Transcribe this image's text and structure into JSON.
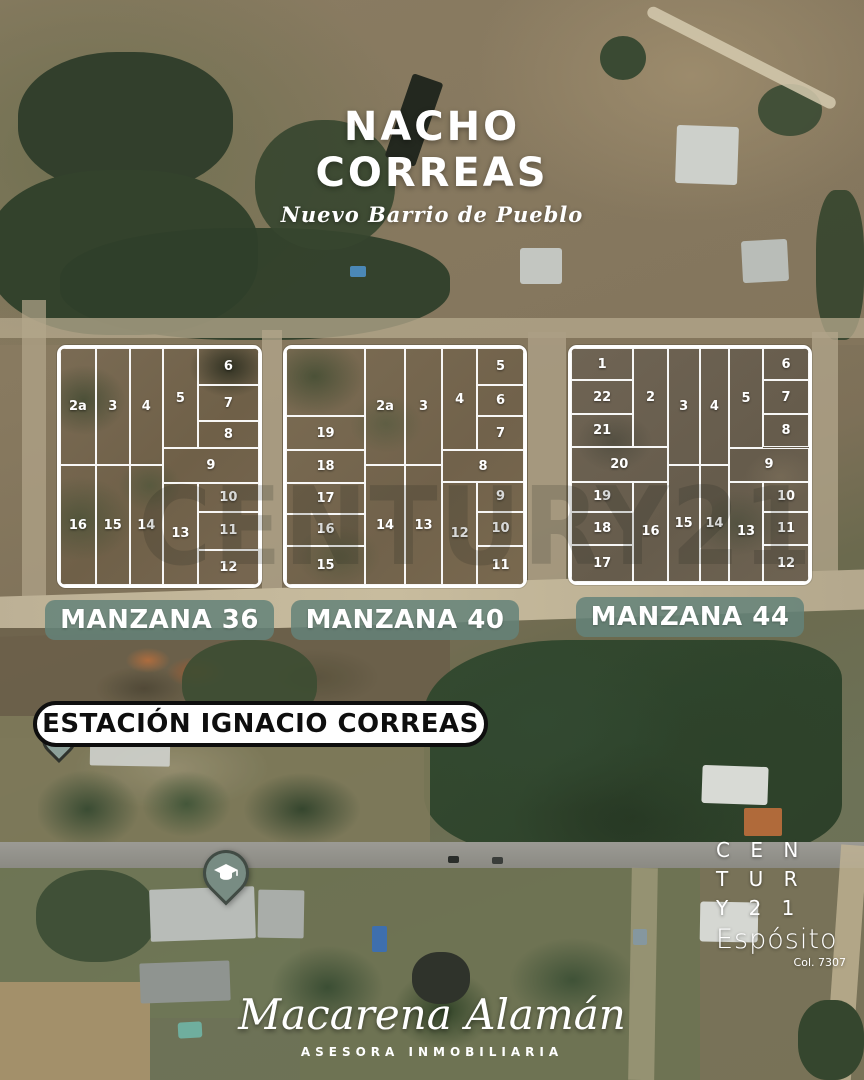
{
  "title": {
    "line1": "NACHO",
    "line2": "CORREAS",
    "subtitle": "Nuevo Barrio de Pueblo"
  },
  "watermark": {
    "text": "CENTURY21"
  },
  "station": {
    "label": "ESTACIÓN IGNACIO CORREAS"
  },
  "map_pins": [
    {
      "name": "station-location-pin",
      "icon": "location-pin",
      "color": "#8DA19A"
    },
    {
      "name": "school-pin",
      "icon": "graduation-cap",
      "color": "#788C83"
    }
  ],
  "colors": {
    "badge_bg": "#64827A",
    "lot_line": "#FFFFFF",
    "station_pill_bg": "#FFFFFF",
    "station_pill_border": "#0E0E0E",
    "text_white": "#FFFFFF"
  },
  "blocks": [
    {
      "id": "36",
      "badge": "MANZANA 36",
      "rect": {
        "left": 57,
        "top": 345,
        "width": 205,
        "height": 243
      },
      "lots": [
        {
          "n": "2a",
          "x": 0,
          "y": 0,
          "w": 18,
          "h": 49.5
        },
        {
          "n": "3",
          "x": 18,
          "y": 0,
          "w": 17,
          "h": 49.5
        },
        {
          "n": "4",
          "x": 35,
          "y": 0,
          "w": 16.7,
          "h": 49.5
        },
        {
          "n": "5",
          "x": 51.7,
          "y": 0,
          "w": 17.6,
          "h": 42.4
        },
        {
          "n": "6",
          "x": 69.3,
          "y": 0,
          "w": 30.7,
          "h": 15.6
        },
        {
          "n": "7",
          "x": 69.3,
          "y": 15.6,
          "w": 30.7,
          "h": 15.3
        },
        {
          "n": "8",
          "x": 69.3,
          "y": 30.9,
          "w": 30.7,
          "h": 11.5
        },
        {
          "n": "9",
          "x": 51.7,
          "y": 42.4,
          "w": 48.3,
          "h": 14.4
        },
        {
          "n": "10",
          "x": 69.3,
          "y": 56.8,
          "w": 30.7,
          "h": 12.3
        },
        {
          "n": "11",
          "x": 69.3,
          "y": 69.1,
          "w": 30.7,
          "h": 16.1
        },
        {
          "n": "12",
          "x": 69.3,
          "y": 85.2,
          "w": 30.7,
          "h": 14.8
        },
        {
          "n": "13",
          "x": 51.7,
          "y": 56.8,
          "w": 17.6,
          "h": 43.2
        },
        {
          "n": "14",
          "x": 35,
          "y": 49.5,
          "w": 16.7,
          "h": 50.5
        },
        {
          "n": "15",
          "x": 18,
          "y": 49.5,
          "w": 17,
          "h": 50.5
        },
        {
          "n": "16",
          "x": 0,
          "y": 49.5,
          "w": 18,
          "h": 50.5
        }
      ]
    },
    {
      "id": "40",
      "badge": "MANZANA 40",
      "rect": {
        "left": 283,
        "top": 345,
        "width": 244,
        "height": 243
      },
      "lots": [
        {
          "n": "",
          "x": 0,
          "y": 0,
          "w": 33.2,
          "h": 28.8
        },
        {
          "n": "19",
          "x": 0,
          "y": 28.8,
          "w": 33.2,
          "h": 14.4
        },
        {
          "n": "18",
          "x": 0,
          "y": 43.2,
          "w": 33.2,
          "h": 13.6
        },
        {
          "n": "17",
          "x": 0,
          "y": 56.8,
          "w": 33.2,
          "h": 13.2
        },
        {
          "n": "16",
          "x": 0,
          "y": 70,
          "w": 33.2,
          "h": 13.5
        },
        {
          "n": "15",
          "x": 0,
          "y": 83.5,
          "w": 33.2,
          "h": 16.5
        },
        {
          "n": "2a",
          "x": 33.2,
          "y": 0,
          "w": 16.8,
          "h": 49.4
        },
        {
          "n": "3",
          "x": 50,
          "y": 0,
          "w": 15.6,
          "h": 49.4
        },
        {
          "n": "14",
          "x": 33.2,
          "y": 49.4,
          "w": 16.8,
          "h": 50.6
        },
        {
          "n": "13",
          "x": 50,
          "y": 49.4,
          "w": 15.6,
          "h": 50.6
        },
        {
          "n": "4",
          "x": 65.6,
          "y": 0,
          "w": 14.7,
          "h": 43.2
        },
        {
          "n": "5",
          "x": 80.3,
          "y": 0,
          "w": 19.7,
          "h": 15.6
        },
        {
          "n": "6",
          "x": 80.3,
          "y": 15.6,
          "w": 19.7,
          "h": 13.2
        },
        {
          "n": "7",
          "x": 80.3,
          "y": 28.8,
          "w": 19.7,
          "h": 14.4
        },
        {
          "n": "8",
          "x": 65.6,
          "y": 43.2,
          "w": 34.4,
          "h": 13.2
        },
        {
          "n": "12",
          "x": 65.6,
          "y": 56.4,
          "w": 14.7,
          "h": 43.6
        },
        {
          "n": "9",
          "x": 80.3,
          "y": 56.4,
          "w": 19.7,
          "h": 12.7
        },
        {
          "n": "10",
          "x": 80.3,
          "y": 69.1,
          "w": 19.7,
          "h": 14.4
        },
        {
          "n": "11",
          "x": 80.3,
          "y": 83.5,
          "w": 19.7,
          "h": 16.5
        }
      ]
    },
    {
      "id": "44",
      "badge": "MANZANA 44",
      "rect": {
        "left": 568,
        "top": 345,
        "width": 244,
        "height": 240
      },
      "lots": [
        {
          "n": "1",
          "x": 0,
          "y": 0,
          "w": 26.2,
          "h": 13.8
        },
        {
          "n": "22",
          "x": 0,
          "y": 13.8,
          "w": 26.2,
          "h": 14.5
        },
        {
          "n": "21",
          "x": 0,
          "y": 28.3,
          "w": 26.2,
          "h": 14.2
        },
        {
          "n": "2",
          "x": 26.2,
          "y": 0,
          "w": 14.4,
          "h": 42.5
        },
        {
          "n": "3",
          "x": 40.6,
          "y": 0,
          "w": 13.5,
          "h": 50
        },
        {
          "n": "4",
          "x": 54.1,
          "y": 0,
          "w": 12.3,
          "h": 50
        },
        {
          "n": "5",
          "x": 66.4,
          "y": 0,
          "w": 14.3,
          "h": 42.9
        },
        {
          "n": "6",
          "x": 80.7,
          "y": 0,
          "w": 19.3,
          "h": 13.8
        },
        {
          "n": "7",
          "x": 80.7,
          "y": 13.8,
          "w": 19.3,
          "h": 14.5
        },
        {
          "n": "8",
          "x": 80.7,
          "y": 28.3,
          "w": 19.3,
          "h": 14.2
        },
        {
          "n": "20",
          "x": 0,
          "y": 42.5,
          "w": 40.6,
          "h": 14.6
        },
        {
          "n": "9",
          "x": 66.4,
          "y": 42.9,
          "w": 33.6,
          "h": 14.2
        },
        {
          "n": "19",
          "x": 0,
          "y": 57.1,
          "w": 26.2,
          "h": 12.9
        },
        {
          "n": "18",
          "x": 0,
          "y": 70,
          "w": 26.2,
          "h": 14.2
        },
        {
          "n": "17",
          "x": 0,
          "y": 84.2,
          "w": 26.2,
          "h": 15.8
        },
        {
          "n": "16",
          "x": 26.2,
          "y": 57.1,
          "w": 14.4,
          "h": 42.9
        },
        {
          "n": "15",
          "x": 40.6,
          "y": 50,
          "w": 13.5,
          "h": 50
        },
        {
          "n": "14",
          "x": 54.1,
          "y": 50,
          "w": 12.3,
          "h": 50
        },
        {
          "n": "13",
          "x": 66.4,
          "y": 57.1,
          "w": 14.3,
          "h": 42.9
        },
        {
          "n": "10",
          "x": 80.7,
          "y": 57.1,
          "w": 19.3,
          "h": 12.9
        },
        {
          "n": "11",
          "x": 80.7,
          "y": 70,
          "w": 19.3,
          "h": 14.2
        },
        {
          "n": "12",
          "x": 80.7,
          "y": 84.2,
          "w": 19.3,
          "h": 15.8
        }
      ]
    }
  ],
  "branding": {
    "century_lines": [
      "C  E  N",
      "T  U  R",
      "Y  2  1"
    ],
    "name": "Espósito",
    "license": "Col. 7307"
  },
  "agent": {
    "name": "Macarena Alamán",
    "role": "ASESORA INMOBILIARIA"
  }
}
